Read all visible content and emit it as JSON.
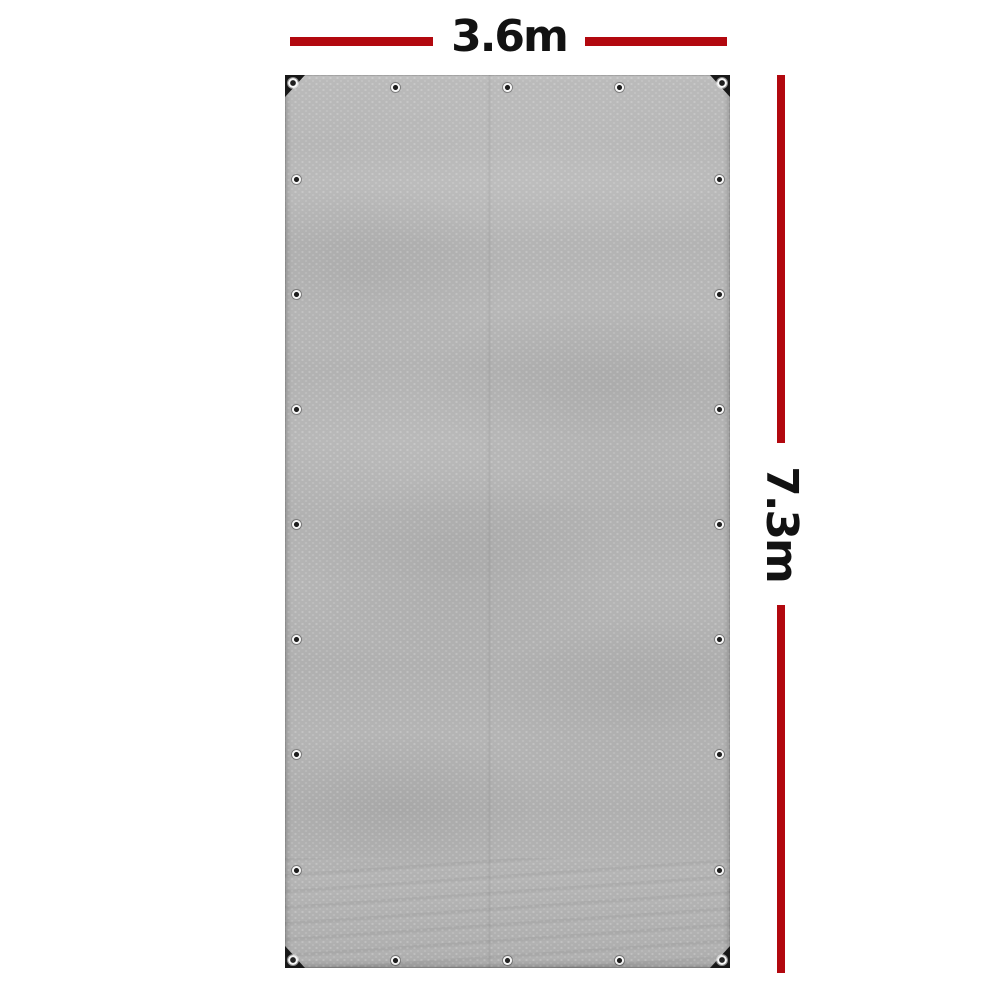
{
  "figure": {
    "width_label": "3.6m",
    "height_label": "7.3m"
  },
  "colors": {
    "background": "#ffffff",
    "dimension_line": "#b2080f",
    "dimension_text": "#121212",
    "tarp_base": "#b4b4b4",
    "corner_patch": "#181818",
    "grommet_ring": "#f7f7f7",
    "grommet_center": "#1e1e1e"
  },
  "tarp": {
    "grommets_top": 3,
    "grommets_bottom": 3,
    "grommets_left": 7,
    "grommets_right": 7,
    "corner_grommets": 4
  }
}
